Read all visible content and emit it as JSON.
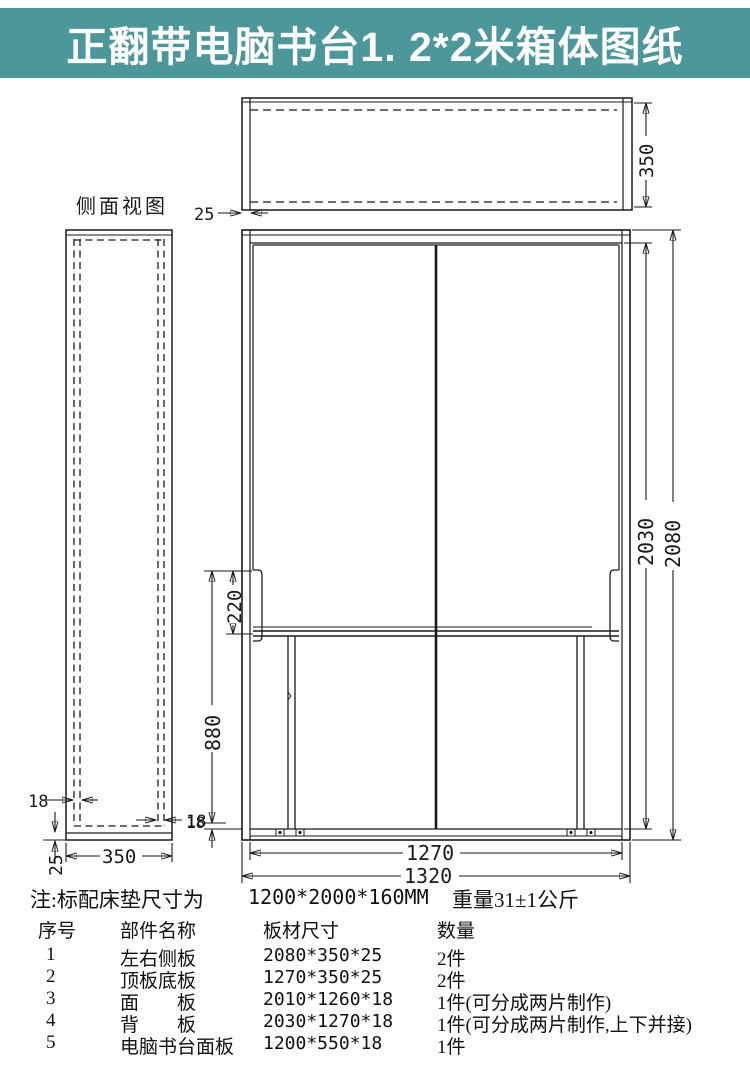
{
  "banner": {
    "title": "正翻带电脑书台1. 2*2米箱体图纸"
  },
  "colors": {
    "banner_bg": "#4d969a",
    "banner_fg": "#ffffff",
    "line": "#1a1a1a"
  },
  "drawing": {
    "side_view": {
      "label": "侧面视图",
      "dims": {
        "panel_thickness_left": "18",
        "panel_thickness_right": "18",
        "bottom_thickness": "25",
        "depth": "350"
      }
    },
    "top_view": {
      "dims": {
        "side_thickness": "25",
        "depth": "350"
      }
    },
    "front_view": {
      "dims": {
        "inner_height": "2030",
        "outer_height": "2080",
        "desk_offset": "220",
        "desk_height": "880",
        "bottom_thickness": "18",
        "inner_width": "1270",
        "outer_width": "1320"
      }
    }
  },
  "note": {
    "label": "注:标配床垫尺寸为",
    "mattress_size": "1200*2000*160MM",
    "weight": "重量31±1公斤"
  },
  "parts_table": {
    "headers": [
      "序号",
      "部件名称",
      "板材尺寸",
      "数量"
    ],
    "rows": [
      {
        "no": "1",
        "name": "左右侧板",
        "size": "2080*350*25",
        "qty": "2件"
      },
      {
        "no": "2",
        "name": "顶板底板",
        "size": "1270*350*25",
        "qty": "2件"
      },
      {
        "no": "3",
        "name": "面　　板",
        "size": "2010*1260*18",
        "qty": "1件(可分成两片制作)"
      },
      {
        "no": "4",
        "name": "背　　板",
        "size": "2030*1270*18",
        "qty": "1件(可分成两片制作,上下并接)"
      },
      {
        "no": "5",
        "name": "电脑书台面板",
        "size": "1200*550*18",
        "qty": "1件"
      }
    ]
  }
}
